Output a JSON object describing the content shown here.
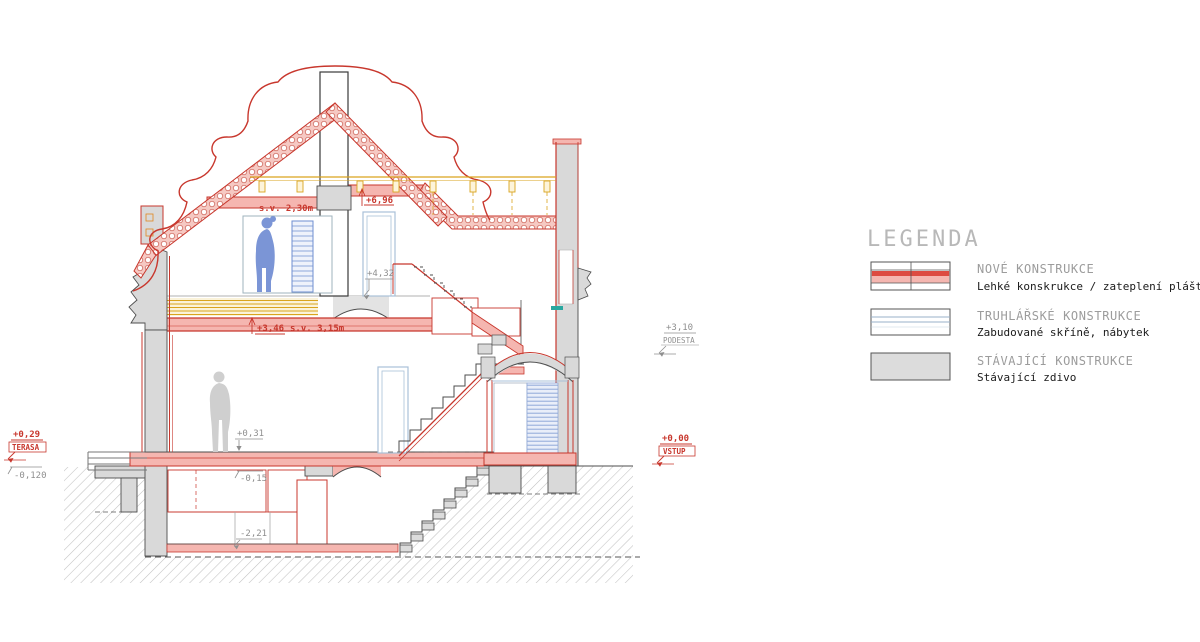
{
  "ann": {
    "sv230": "s.v. 2,30m",
    "l696": "+6,96",
    "l432": "+4,32",
    "l346": "+3,46",
    "sv315": "s.v. 3,15m",
    "l310": "+3,10",
    "podesta": "PODESTA",
    "l029": "+0,29",
    "terasa": "TERASA",
    "lm0120": "-0,120",
    "l031": "+0,31",
    "lm015": "-0,15",
    "lm221": "-2,21",
    "l000": "+0,00",
    "vstup": "VSTUP"
  },
  "legend": {
    "title": "LEGENDA",
    "items": [
      {
        "label": "NOVÉ KONSTRUKCE",
        "desc": "Lehké konskrukce / zateplení pláště objektu"
      },
      {
        "label": "TRUHLÁŘSKÉ KONSTRUKCE",
        "desc": "Zabudované skříně, nábytek"
      },
      {
        "label": "STÁVAJÍCÍ KONSTRUKCE",
        "desc": "Stávající zdivo"
      }
    ]
  },
  "colors": {
    "new_construction_red": "#c8372d",
    "new_construction_fill": "#f5b6b0",
    "existing_masonry_gray": "#d9d9d9",
    "timber_yellow": "#d9a41e",
    "joinery_blue": "#8fa8c8",
    "furniture_blue": "#7b95d6",
    "ground_hatch_gray": "#c2c2c2",
    "accent_teal": "#2aa8a0"
  }
}
